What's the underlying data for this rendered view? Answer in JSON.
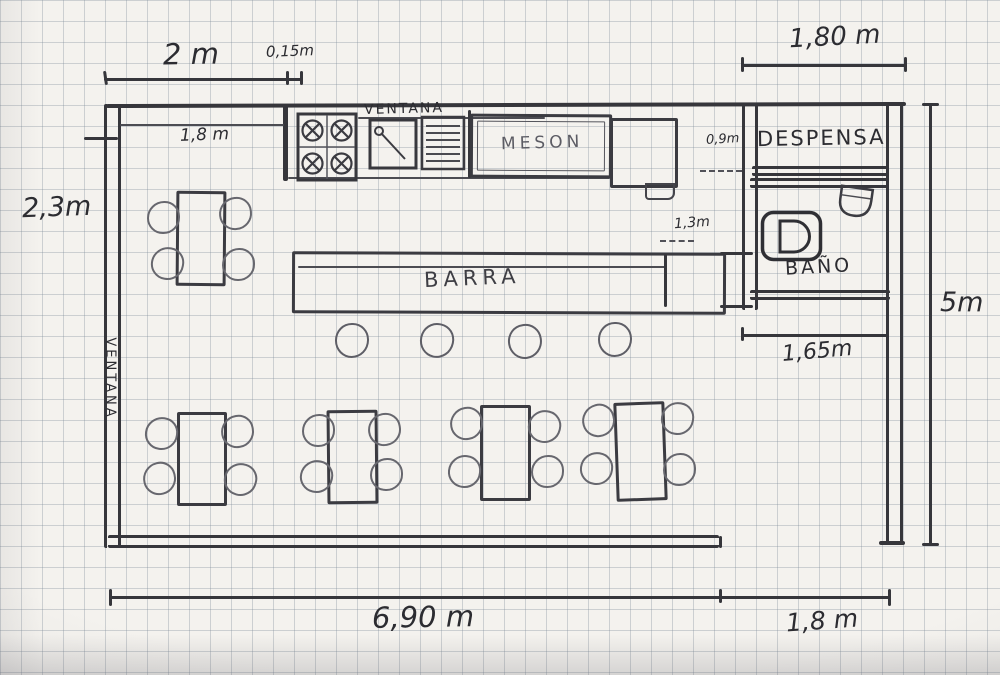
{
  "labels": {
    "ventana_top": "VENTANA",
    "ventana_left": "VENTANA",
    "meson": "MESON",
    "despensa": "DESPENSA",
    "bano": "BAÑO",
    "barra": "BARRA"
  },
  "dimensions": {
    "top_window": "2 m",
    "wall_thickness": "0,15m",
    "top_right": "1,80 m",
    "inner_window": "1,8 m",
    "left_height": "2,3m",
    "right_height": "5m",
    "despensa_opening": "0,9m",
    "pass_width": "1,3m",
    "bano_width": "1,65m",
    "bottom_width": "6,90 m",
    "entrance_width": "1,8 m"
  },
  "colors": {
    "pencil_dark": "#36363b",
    "pencil_light": "#67676e",
    "paper": "#f4f2ee",
    "grid": "#7b8896"
  }
}
